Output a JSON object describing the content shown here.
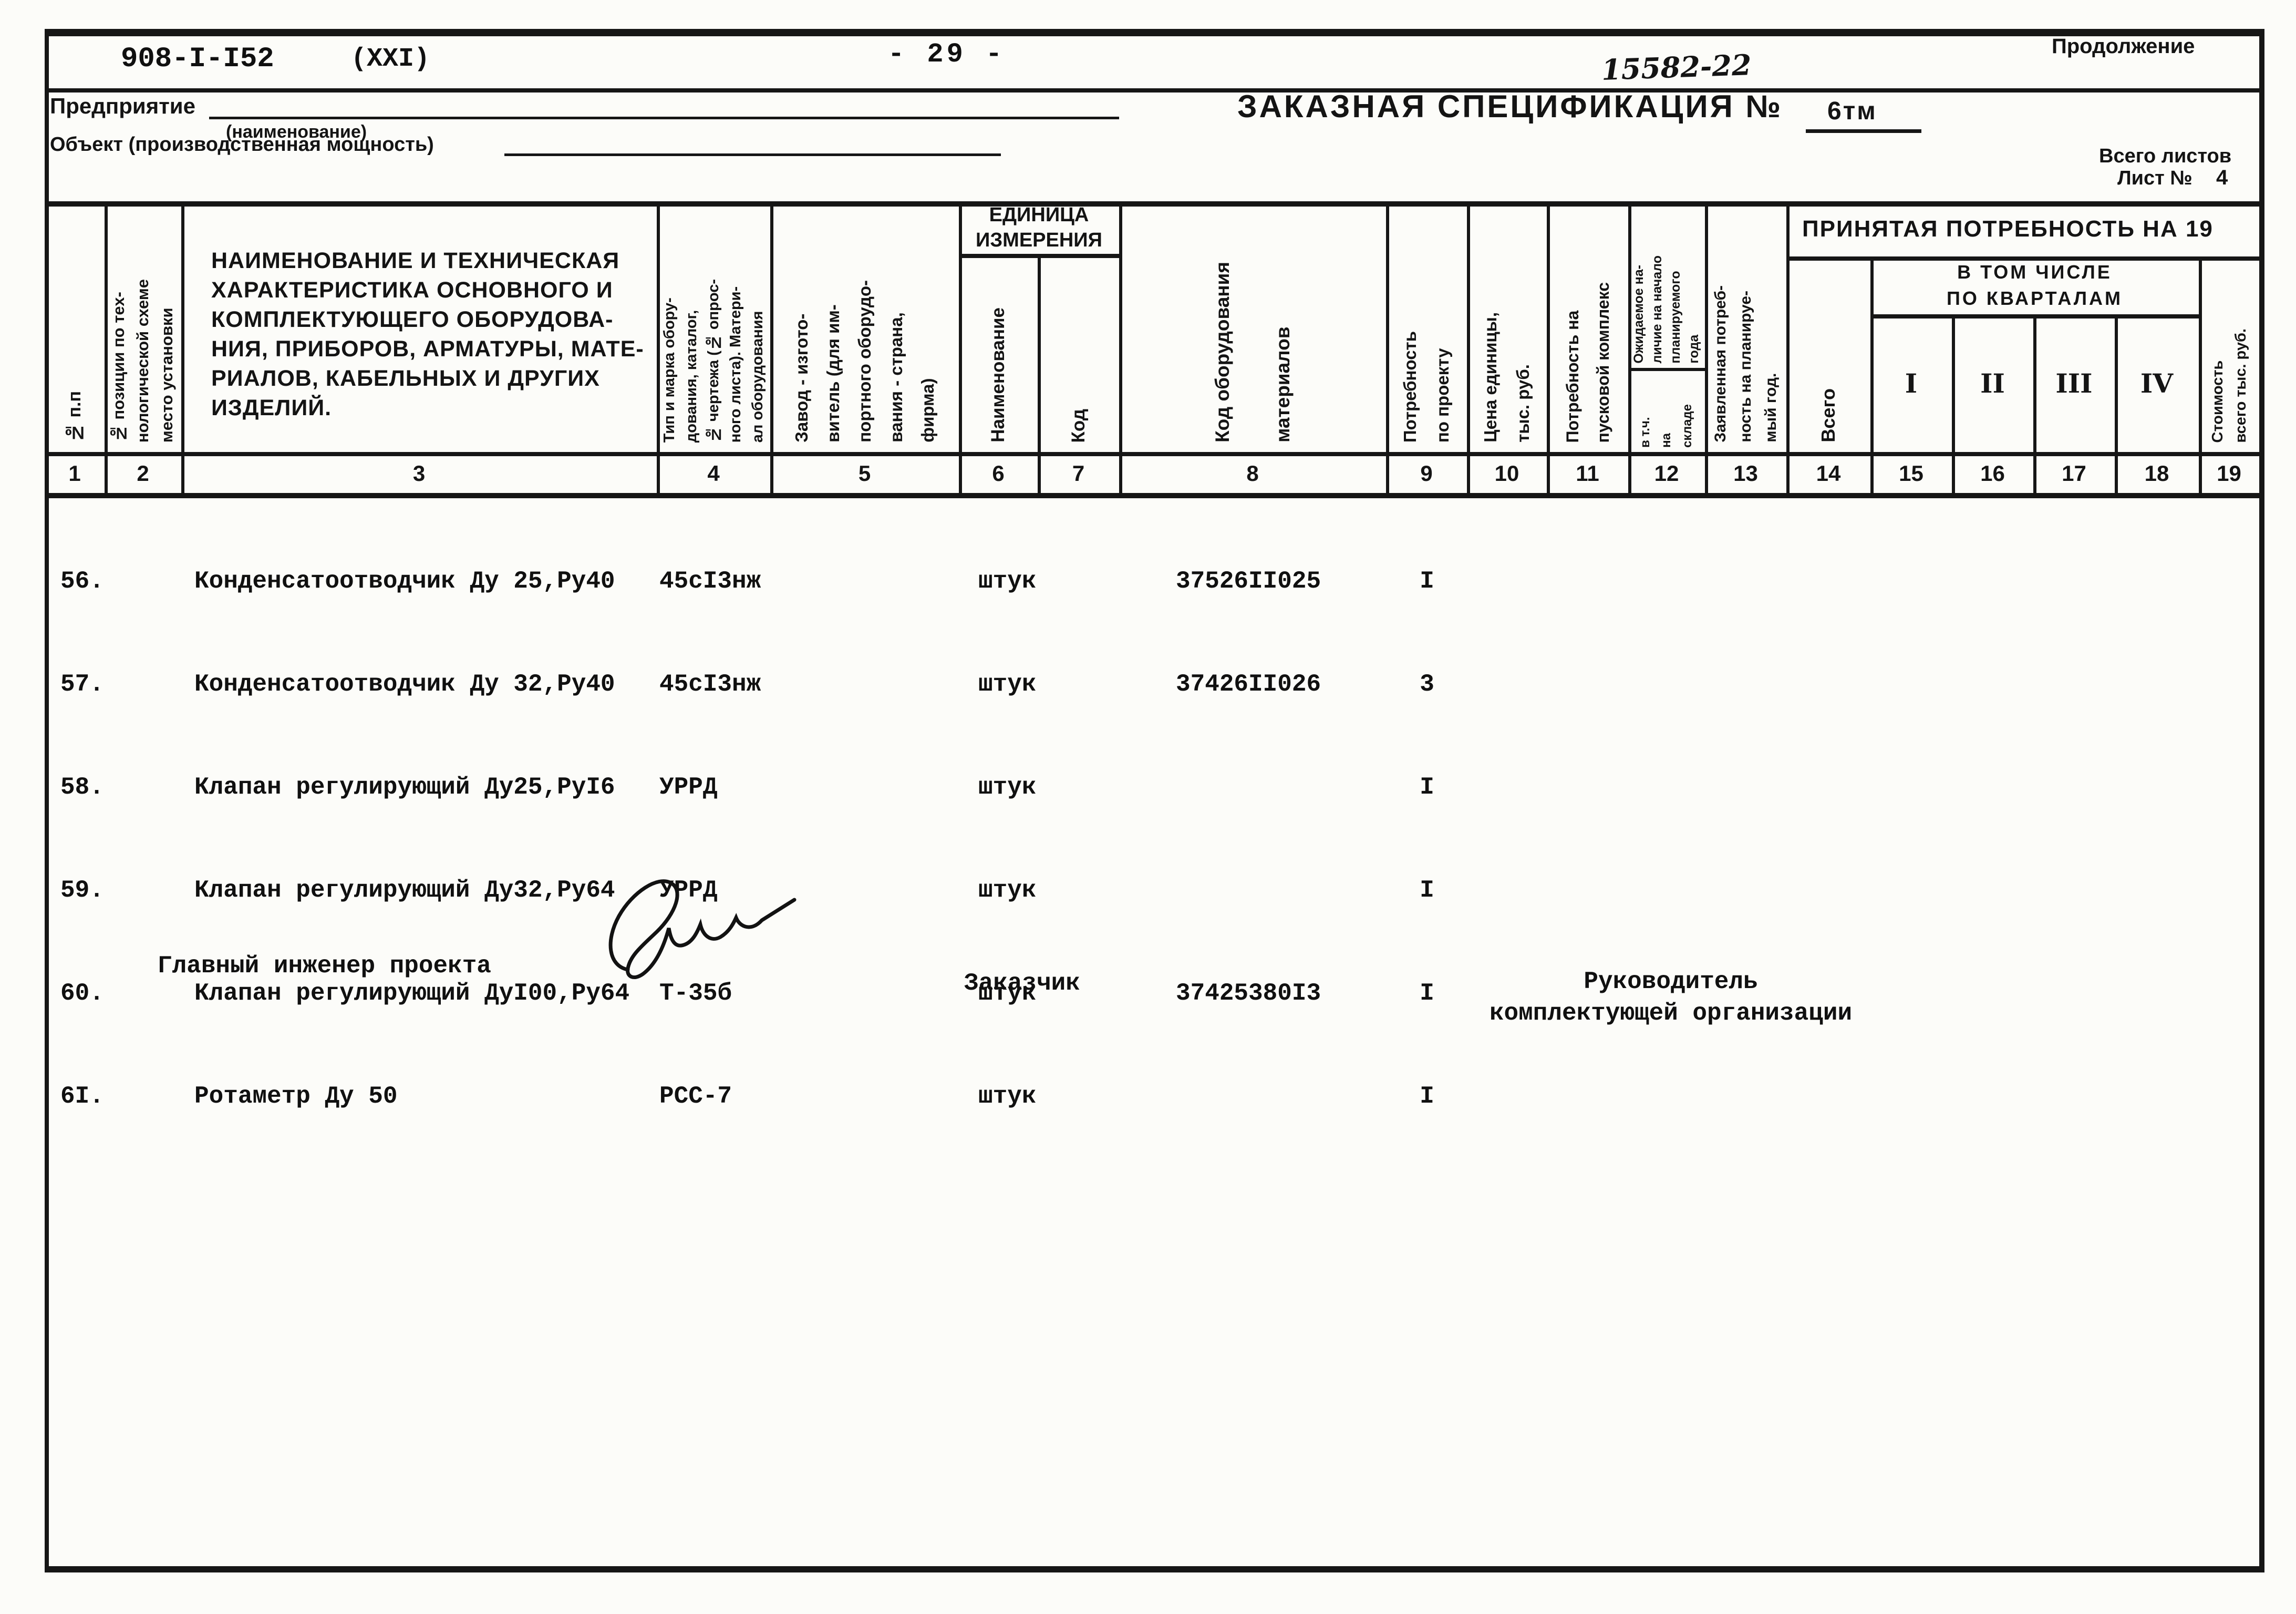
{
  "page": {
    "doc_number": "908-I-I52",
    "doc_series": "(XXI)",
    "page_number": "- 29 -",
    "handwritten_number": "15582-22",
    "continuation_label": "Продолжение",
    "form": {
      "enterprise_label": "Предприятие",
      "enterprise_hint": "(наименование)",
      "object_label": "Объект (производственная мощность)",
      "title": "ЗАКАЗНАЯ СПЕЦИФИКАЦИЯ №",
      "spec_number": "6тм",
      "total_sheets_label": "Всего листов",
      "sheet_label": "Лист №",
      "sheet_number": "4"
    }
  },
  "table": {
    "headers": {
      "c1": "№ п.п",
      "c2": "№ позиции по тех-\nнологической схеме\nместо установки",
      "c3": "НАИМЕНОВАНИЕ И ТЕХНИЧЕСКАЯ\nХАРАКТЕРИСТИКА ОСНОВНОГО И\nКОМПЛЕКТУЮЩЕГО ОБОРУДОВА-\nНИЯ, ПРИБОРОВ, АРМАТУРЫ, МАТЕ-\nРИАЛОВ, КАБЕЛЬНЫХ И ДРУГИХ\nИЗДЕЛИЙ.",
      "c4": "Тип и марка обору-\nдования, каталог,\n№ чертежа (№ опрос-\nного листа). Матери-\nал оборудования",
      "c5": "Завод - изгото-\nвитель (для им-\nпортного оборудо-\nвания - страна,\nфирма)",
      "unit_group": "ЕДИНИЦА\nИЗМЕРЕНИЯ",
      "c6": "Наименование",
      "c7": "Код",
      "c8": "Код оборудования\nматериалов",
      "c9": "Потребность\nпо проекту",
      "c10": "Цена единицы,\nтыс. руб.",
      "c11": "Потребность на\nпусковой комплекс",
      "c12": "Ожидаемое на-\nличие на начало\nпланируемого\nгода",
      "c12_sub": "в т.ч.\nна\nскладе",
      "c13": "Заявленная потреб-\nность на планируе-\nмый год.",
      "accepted_group": "ПРИНЯТАЯ  ПОТРЕБНОСТЬ  НА 19",
      "c14": "Всего",
      "quarters_group": "В ТОМ   ЧИСЛЕ\nПО  КВАРТАЛАМ",
      "c15": "I",
      "c16": "II",
      "c17": "III",
      "c18": "IV",
      "c19": "Стоимость\nвсего тыс. руб."
    },
    "col_numbers": [
      "1",
      "2",
      "3",
      "4",
      "5",
      "6",
      "7",
      "8",
      "9",
      "10",
      "11",
      "12",
      "13",
      "14",
      "15",
      "16",
      "17",
      "18",
      "19"
    ]
  },
  "rows": [
    {
      "num": "56.",
      "name": "Конденсатоотводчик Ду 25,Ру40",
      "type": "45сI3нж",
      "unit": "штук",
      "code": "37526II025",
      "qty": "I"
    },
    {
      "num": "57.",
      "name": "Конденсатоотводчик Ду 32,Ру40",
      "type": "45сI3нж",
      "unit": "штук",
      "code": "37426II026",
      "qty": "3"
    },
    {
      "num": "58.",
      "name": "Клапан регулирующий Ду25,РуI6",
      "type": "УРРД",
      "unit": "штук",
      "code": "",
      "qty": "I"
    },
    {
      "num": "59.",
      "name": "Клапан регулирующий Ду32,Ру64",
      "type": "УРРД",
      "unit": "штук",
      "code": "",
      "qty": "I"
    },
    {
      "num": "60.",
      "name": "Клапан регулирующий ДуI00,Ру64",
      "type": "Т-35б",
      "unit": "штук",
      "code": "37425380I3",
      "qty": "I"
    },
    {
      "num": "6I.",
      "name": "Ротаметр Ду 50",
      "type": "РСС-7",
      "unit": "штук",
      "code": "",
      "qty": "I"
    }
  ],
  "signatures": {
    "chief_engineer_label": "Главный инженер проекта",
    "customer_label": "Заказчик",
    "head_label": "Руководитель\nкомплектующей организации"
  }
}
